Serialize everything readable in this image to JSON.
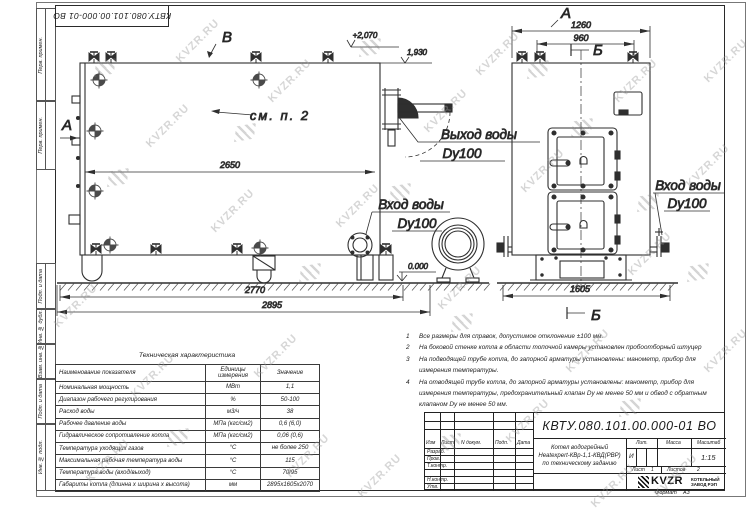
{
  "watermark": {
    "text": "KVZR.RU"
  },
  "margin": {
    "labels": [
      "Перв. примен.",
      "Перв. примен.",
      "Подп. и дата",
      "Инв. № дубл.",
      "Взам. инв. №",
      "Подп. и дата",
      "Инв. № подл."
    ]
  },
  "drawing": {
    "view_labels": {
      "a": "А",
      "b": "Б",
      "v": "В"
    },
    "elevations": {
      "top": "+2,070",
      "mid": "1,930",
      "zero": "0.000"
    },
    "see_note": "см. п. 2",
    "labels": {
      "outlet1": "Выход воды",
      "outlet2": "Dy100",
      "inlet1": "Вход воды",
      "inlet2": "Dy100"
    },
    "dimensions": {
      "d2650": "2650",
      "d2770": "2770",
      "d2895": "2895",
      "d1260": "1260",
      "d960": "960",
      "d1605": "1605"
    }
  },
  "notes": {
    "items": [
      {
        "num": "1",
        "text": "Все размеры для справок, допустимое отклонение ±100 мм."
      },
      {
        "num": "2",
        "text": "На боковой стенке котла в области топочной камеры установлен пробоотборный штуцер"
      },
      {
        "num": "3",
        "text": "На подводящей трубе котла, до запорной арматуры установлены: манометр, прибор для измерения температуры."
      },
      {
        "num": "4",
        "text": "На отводящей трубе котла, до запорной арматуры установлены: манометр, прибор для измерения температуры, предохранительный клапан Dу не менее 50 мм и обвод с обратным клапаном Dу не менее 50 мм."
      }
    ]
  },
  "tech_table": {
    "title": "Техническая характеристика",
    "headers": [
      "Наименование показателя",
      "Единицы измерения",
      "Значение"
    ],
    "rows": [
      [
        "Номинальная мощность",
        "МВт",
        "1,1"
      ],
      [
        "Диапазон рабочего регулирования",
        "%",
        "50-100"
      ],
      [
        "Расход воды",
        "м3/ч",
        "38"
      ],
      [
        "Рабочее давление воды",
        "МПа (кгс/см2)",
        "0,6 (6,0)"
      ],
      [
        "Гидравлическое сопротивление котла",
        "МПа (кгс/см2)",
        "0,06 (0,6)"
      ],
      [
        "Температура уходящих газов",
        "°С",
        "не более 250"
      ],
      [
        "Максимальная рабочая температура воды",
        "°С",
        "115"
      ],
      [
        "Температура воды (вход/выход)",
        "°С",
        "70/95"
      ],
      [
        "Габариты котла (длинна х ширина х высота)",
        "мм",
        "2895х1605х2070"
      ]
    ]
  },
  "title_block": {
    "doc_number": "КВТУ.080.101.00.000-01 ВО",
    "header_cells": [
      "Изм",
      "Лист",
      "N докум.",
      "Подп.",
      "Дата"
    ],
    "row_labels": [
      "Разраб.",
      "Пров.",
      "Т.контр.",
      "Н.контр.",
      "Утв."
    ],
    "description_line1": "Котел водогрейный",
    "description_line2": "Heatexpert-КВр-1,1-КВД(РВР)",
    "description_line3": "по техническому заданию",
    "lit_label": "Лит.",
    "lit_value": "И",
    "mass_label": "Масса",
    "scale_label": "Масштаб",
    "scale_value": "1:15",
    "sheet_label": "Лист",
    "sheet_value": "1",
    "sheets_label": "Листов",
    "sheets_value": "2",
    "company_logo": "KVZR",
    "company_line1": "КОТЕЛЬНЫЙ",
    "company_line2": "ЗАВОД РЭП",
    "format_label": "Формат",
    "format_value": "А3"
  }
}
